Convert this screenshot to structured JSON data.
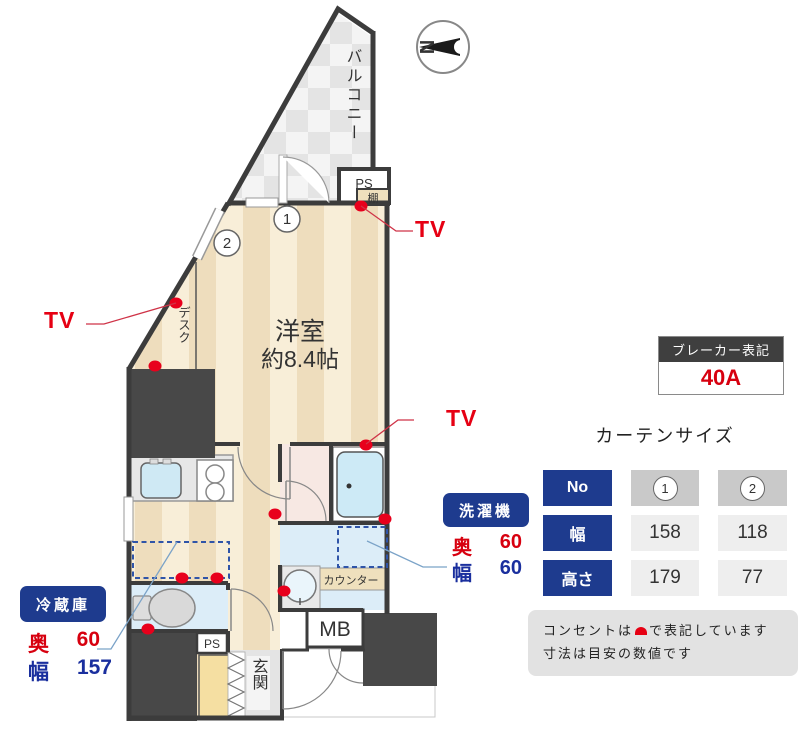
{
  "compass": {
    "letter": "N"
  },
  "plan": {
    "balcony": "バルコニー",
    "room_name": "洋室",
    "room_size": "約8.4帖",
    "desk": "デスク",
    "shelf": "棚",
    "ps_top": "PS",
    "ps_bottom": "PS",
    "counter": "カウンター",
    "mb": "MB",
    "entrance": "玄関",
    "tv": "TV",
    "curtain1": "1",
    "curtain2": "2"
  },
  "breaker": {
    "title": "ブレーカー表記",
    "value": "40A"
  },
  "curtain": {
    "title": "カーテンサイズ",
    "row_no": "No",
    "row_width": "幅",
    "row_height": "高さ",
    "col1_no": "1",
    "col2_no": "2",
    "col1_width": "158",
    "col2_width": "118",
    "col1_height": "179",
    "col2_height": "77"
  },
  "washer": {
    "title": "洗濯機",
    "depth_label": "奥",
    "depth_value": "60",
    "width_label": "幅",
    "width_value": "60"
  },
  "fridge": {
    "title": "冷蔵庫",
    "depth_label": "奥",
    "depth_value": "60",
    "width_label": "幅",
    "width_value": "157"
  },
  "note": {
    "line1_before": "コンセントは",
    "line1_after": "で表記しています",
    "line2": "寸法は目安の数値です"
  },
  "colors": {
    "accent_red": "#e60013",
    "navy": "#1e3b8e",
    "wall": "#3c3c3c",
    "blue_text": "#1a2f9e"
  }
}
